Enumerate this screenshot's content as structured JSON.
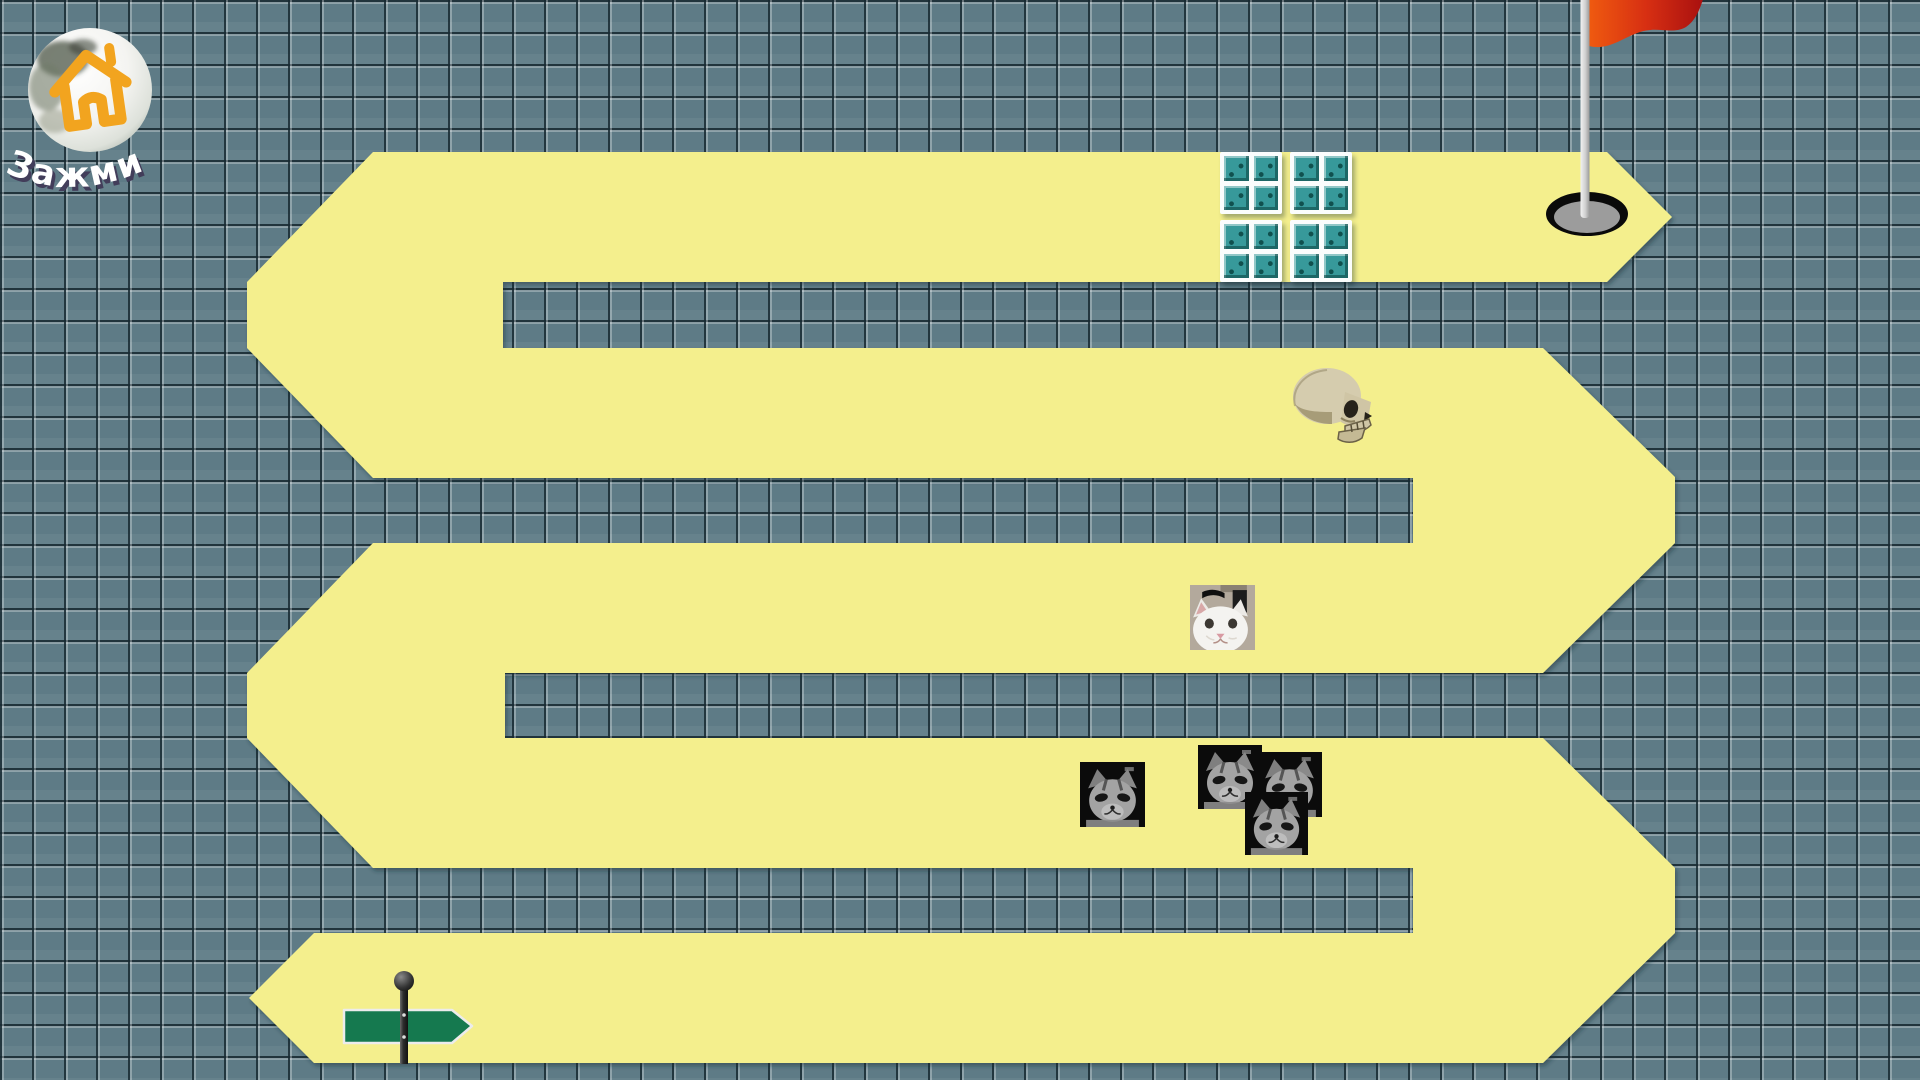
{
  "game": {
    "home_button": {
      "label": "Зажми"
    },
    "colors": {
      "path": "#f4ef8d",
      "tile_base": "#5e7b86",
      "tile_line": "#42565f",
      "tile_highlight": "#87a1a9",
      "flag_red_left": "#ef5a10",
      "flag_red_right": "#b51311",
      "pole_gray": "#d9d9d9",
      "hole_black": "#0a0a0a",
      "hole_gray": "#9c9c9c",
      "sign_green": "#15794f",
      "ice_teal": "#37999a",
      "house_orange": "#f2a41f",
      "label_white": "#ffffff",
      "label_shadow": "#423d5a"
    },
    "objects": {
      "flag": "goal-flag",
      "hole": "goal-hole",
      "ice_blocks": "ice-block-obstacles",
      "skull": "skull-obstacle",
      "white_cat": "white-cat-obstacle",
      "gray_cats": "gray-cat-obstacles",
      "signpost": "start-signpost"
    }
  }
}
